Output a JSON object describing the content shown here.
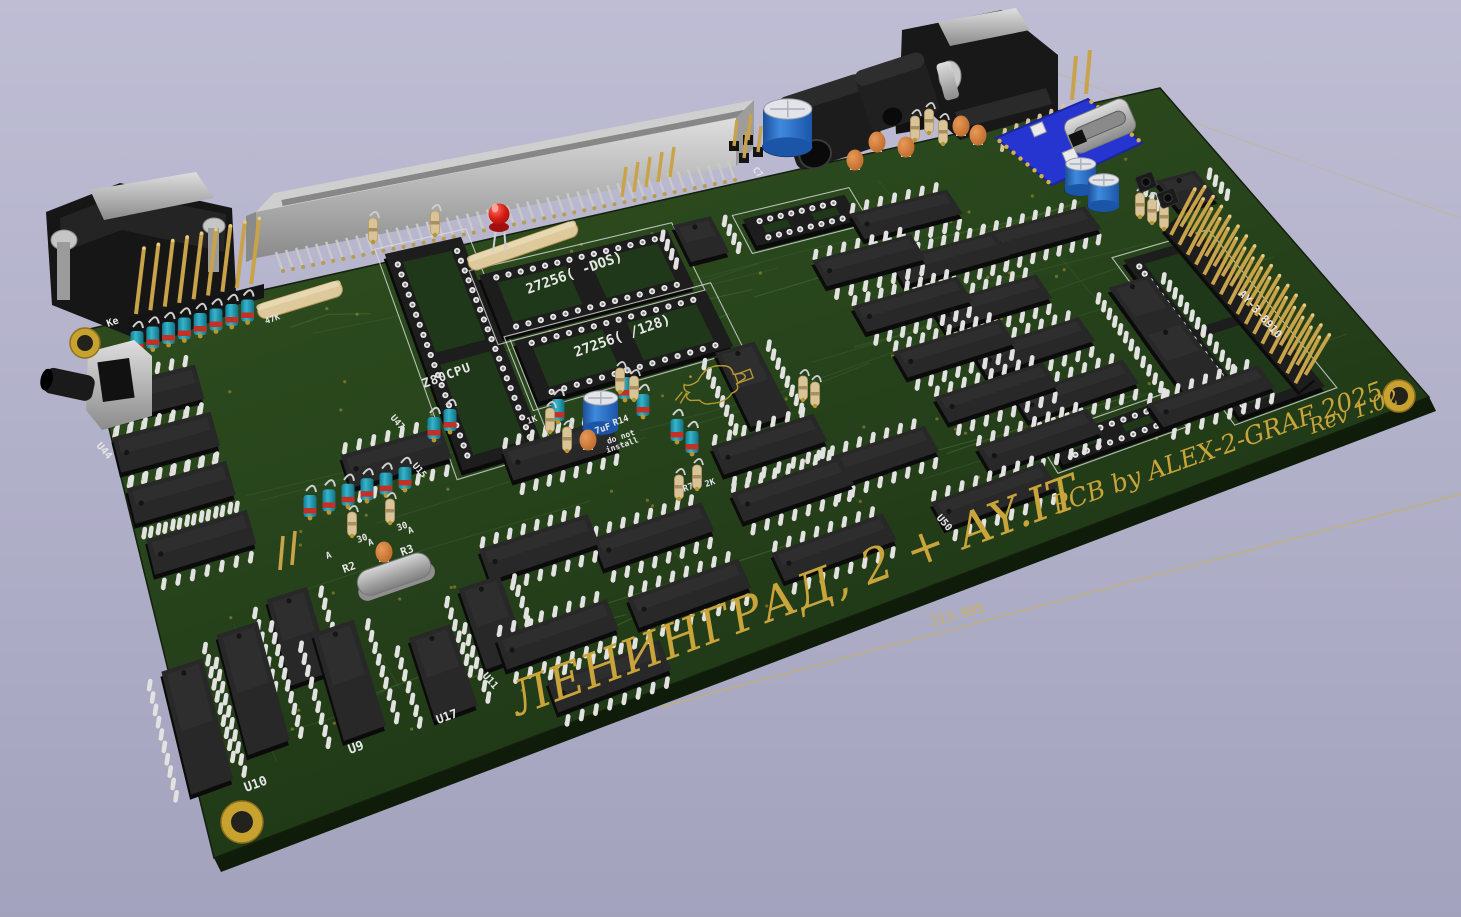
{
  "board": {
    "title_silkscreen": "ЛЕНИНГРАД, 2 + AY.IT",
    "credit_silkscreen": "PCB by ALEX-2-GRAF 2025",
    "revision_silkscreen": "Rev 1.02",
    "dimension_mm": "213.995",
    "cpu_socket_label": "Z80CPU",
    "rom1_socket_label": "27256(  -DOS)",
    "rom2_socket_label": "27256(  /128)",
    "sound_socket_label": "AY-3-8910",
    "keyboard_label": "Ke",
    "cap_value_label": "7uF",
    "note_line1": "do not",
    "note_line2": "install"
  },
  "refs": {
    "u10": "U10",
    "u9": "U9",
    "u17": "U17",
    "u11": "U11",
    "u44": "U44",
    "u47": "U47",
    "u15": "U15",
    "u50": "U50",
    "r2": "R2",
    "r3": "R3",
    "r7": "R7",
    "r14": "R14",
    "c7": "C7",
    "r_1k": "1K",
    "r_2k": "2K",
    "r_30a": "30",
    "r_30b": "30",
    "a1": "A",
    "a2": "A",
    "a3": "A",
    "k47": "47K"
  },
  "colors": {
    "background": "#b2b1c9",
    "board_green": "#26441d",
    "silkscreen_white": "#e6e6e6",
    "silkscreen_yellow": "#c9a43a",
    "solder_gold": "#c19a32",
    "ic_black": "#1a1a1a",
    "capacitor_blue": "#2f7fd0",
    "capacitor_teal": "#2aa7bd",
    "capacitor_orange": "#d9813c",
    "led_red": "#cc1613",
    "usb_module_blue": "#2635cf"
  }
}
